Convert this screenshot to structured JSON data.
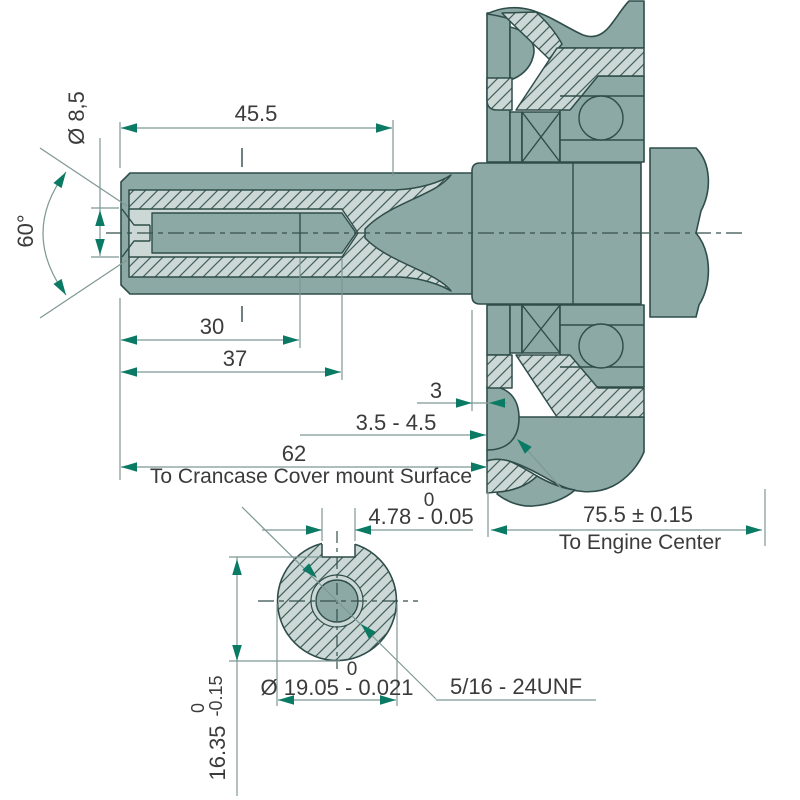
{
  "drawing": {
    "type": "engine crankshaft PTO dimension drawing",
    "views": [
      "side section view",
      "shaft end cross-section"
    ],
    "dimensions": {
      "end_diameter": "Ø 8,5",
      "thread_length": "45.5",
      "center_hole_angle": "60°",
      "full_thread_depth": "30",
      "hole_depth": "37",
      "seal_offset": "3",
      "seal_working_range": "3.5 - 4.5",
      "shaft_length_to_cover": "62",
      "shaft_length_note": "To Crancase Cover mount Surface",
      "keyway_width_upper_tol": "0",
      "keyway_width": "4.78 - 0.05",
      "engine_center_distance": "75.5 ± 0.15",
      "engine_center_note": "To Engine Center",
      "shaft_diameter_upper_tol": "0",
      "shaft_diameter": "Ø 19.05 - 0.021",
      "thread_spec": "5/16 - 24UNF",
      "keyway_depth_upper_tol": "0",
      "keyway_depth_lower_tol": "-0.15",
      "keyway_depth": "16.35"
    },
    "colors": {
      "part_fill": "#8CA9A5",
      "section_fill": "#CBD8D5",
      "outline": "#2F4D4A",
      "hatch_line": "#44605B",
      "dimension_accent": "#0A7A64",
      "dimension_line": "#7E9894",
      "text": "#3B3B3B",
      "background": "#FFFFFF"
    }
  }
}
